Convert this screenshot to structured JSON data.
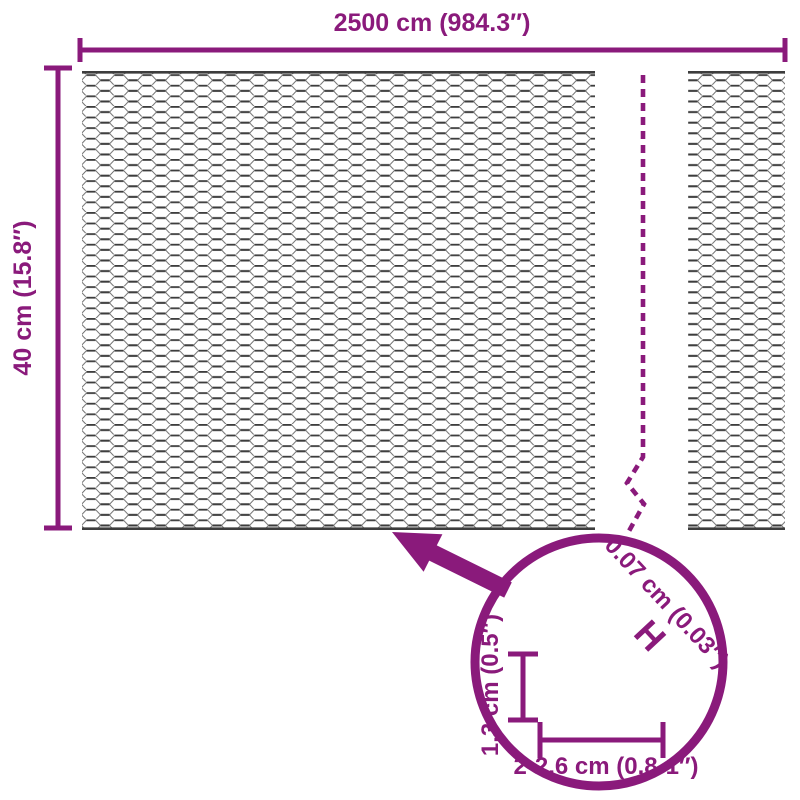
{
  "labels": {
    "total_width": "2500 cm (984.3″)",
    "total_height": "40 cm (15.8″)",
    "mesh_cell_height": "1,3 cm (0.5″)",
    "mesh_cell_width": "2-2,6 cm (0.8-1″)",
    "wire_thickness": "0.07 cm (0.03″)",
    "wire_thickness_marker": "H"
  },
  "colors": {
    "accent_purple": "#8A1A7B",
    "wire_dark": "#3D3D3D",
    "wire_mid": "#6E6E6E",
    "wire_light": "#7A7A7A",
    "background": "#FFFFFF"
  }
}
